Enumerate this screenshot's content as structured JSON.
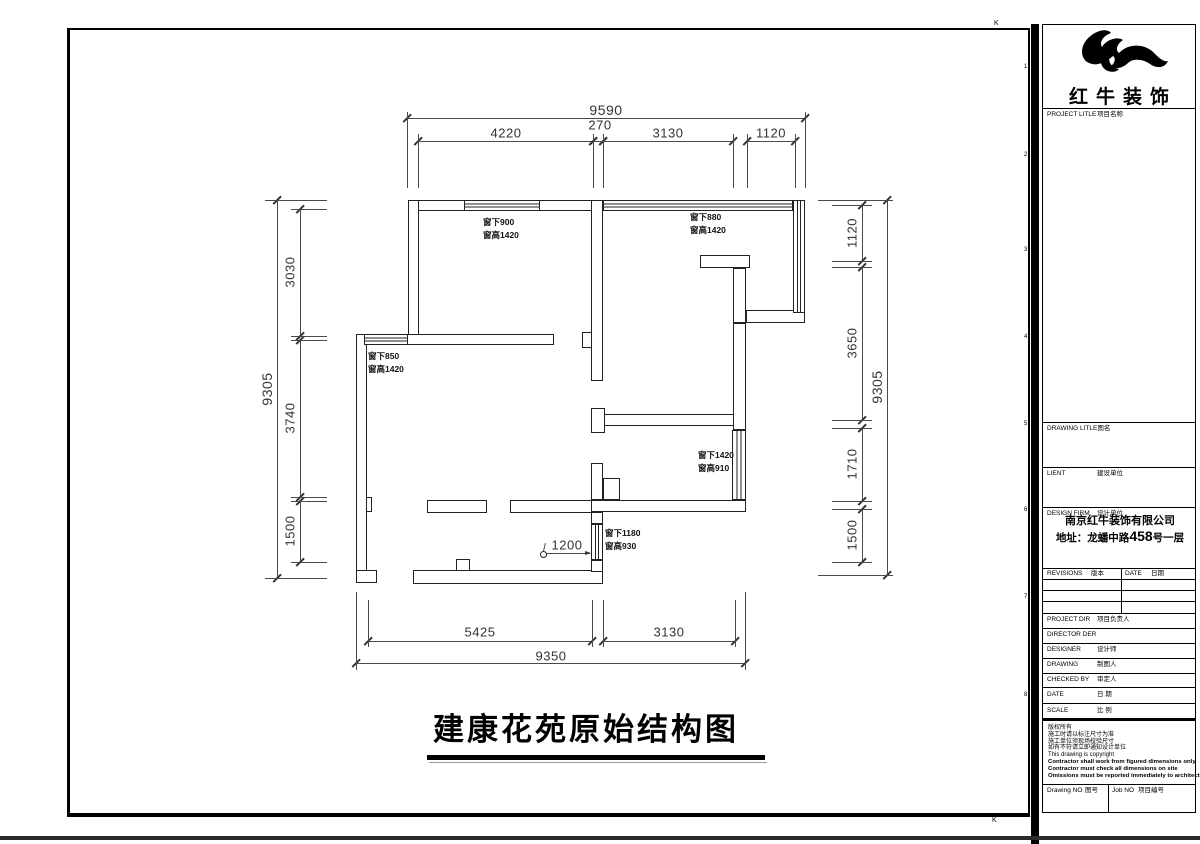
{
  "sheet": {
    "title": "建康花苑原始结构图",
    "grid_ref_top": "K",
    "grid_ref_bottom": "K",
    "side_numbers": [
      "1",
      "2",
      "3",
      "4",
      "5",
      "6",
      "7",
      "8"
    ]
  },
  "title_block": {
    "brand": "红牛装饰",
    "project_title_label": {
      "en": "PROJECT LITLE",
      "cn": "项目名称"
    },
    "drawing_title_label": {
      "en": "DRAWING LITLE",
      "cn": "图名"
    },
    "client_label": {
      "en": "LIENT",
      "cn": "建设单位"
    },
    "design_firm_label": {
      "en": "DESIGN FIRM",
      "cn": "设计单位"
    },
    "firm_name": "南京红牛装饰有限公司",
    "firm_address": {
      "prefix": "地址：龙蟠中路",
      "number": "458",
      "suffix": "号一层"
    },
    "revisions_label": {
      "en": "REVISIONS",
      "cn": "版本"
    },
    "rev_date_label": {
      "en": "DATE",
      "cn": "日期"
    },
    "project_dir_label": {
      "en": "PROJECT DIR",
      "cn": "项目负责人"
    },
    "director_label": {
      "en": "DIRECTOR DER",
      "cn": ""
    },
    "designer_label": {
      "en": "DESIGNER",
      "cn": "设计师"
    },
    "drawing_label": {
      "en": "DRAWING",
      "cn": "制图人"
    },
    "checked_label": {
      "en": "CHECKED BY",
      "cn": "审定人"
    },
    "date_label": {
      "en": "DATE",
      "cn": "日 期"
    },
    "scale_label": {
      "en": "SCALE",
      "cn": "比 例"
    },
    "drawing_no_label": {
      "en": "Drawing NO",
      "cn": "图号"
    },
    "job_no_label": {
      "en": "Job NO",
      "cn": "项目编号"
    },
    "copyright_lines": [
      {
        "text": "版权所有",
        "bold": false
      },
      {
        "text": "施工时请以标注尺寸为准",
        "bold": false
      },
      {
        "text": "施工单位须现场校验尺寸",
        "bold": false
      },
      {
        "text": "如有不符请立即通知设计单位",
        "bold": false
      },
      {
        "text": "This drawing is copyright",
        "bold": false
      },
      {
        "text": "Contractor shall work from figured dimensions only",
        "bold": true
      },
      {
        "text": "Contractor must check all dimensions on site",
        "bold": true
      },
      {
        "text": "Omissions must be reported immediately to architects",
        "bold": true
      }
    ]
  },
  "plan": {
    "walls": [
      [
        408,
        200,
        58,
        11
      ],
      [
        538,
        200,
        65,
        11
      ],
      [
        408,
        200,
        11,
        145
      ],
      [
        406,
        334,
        148,
        11
      ],
      [
        356,
        334,
        11,
        240
      ],
      [
        366,
        497,
        6,
        15
      ],
      [
        356,
        570,
        21,
        13
      ],
      [
        413,
        570,
        190,
        14
      ],
      [
        456,
        559,
        14,
        12
      ],
      [
        591,
        200,
        12,
        181
      ],
      [
        582,
        332,
        10,
        16
      ],
      [
        591,
        414,
        155,
        12
      ],
      [
        591,
        408,
        14,
        25
      ],
      [
        700,
        255,
        50,
        13
      ],
      [
        733,
        268,
        13,
        55
      ],
      [
        746,
        310,
        59,
        13
      ],
      [
        733,
        323,
        13,
        107
      ],
      [
        591,
        500,
        155,
        12
      ],
      [
        427,
        500,
        60,
        13
      ],
      [
        510,
        500,
        82,
        13
      ],
      [
        591,
        463,
        12,
        37
      ],
      [
        603,
        478,
        17,
        22
      ],
      [
        591,
        512,
        12,
        12
      ],
      [
        591,
        560,
        12,
        12
      ]
    ],
    "windows": [
      {
        "x": 464,
        "y": 200,
        "w": 76,
        "h": 11,
        "dir": "h"
      },
      {
        "x": 603,
        "y": 200,
        "w": 190,
        "h": 11,
        "dir": "h"
      },
      {
        "x": 793,
        "y": 200,
        "w": 12,
        "h": 113,
        "dir": "v"
      },
      {
        "x": 364,
        "y": 334,
        "w": 44,
        "h": 11,
        "dir": "h"
      },
      {
        "x": 732,
        "y": 430,
        "w": 14,
        "h": 70,
        "dir": "v"
      },
      {
        "x": 591,
        "y": 524,
        "w": 12,
        "h": 36,
        "dir": "v"
      }
    ],
    "window_notes": [
      {
        "x": 483,
        "y": 216,
        "lines": [
          "窗下900",
          "窗高1420"
        ]
      },
      {
        "x": 690,
        "y": 211,
        "lines": [
          "窗下880",
          "窗高1420"
        ]
      },
      {
        "x": 368,
        "y": 350,
        "lines": [
          "窗下850",
          "窗高1420"
        ]
      },
      {
        "x": 698,
        "y": 449,
        "lines": [
          "窗下1420",
          "窗高910"
        ]
      },
      {
        "x": 605,
        "y": 527,
        "lines": [
          "窗下1180",
          "窗高930"
        ]
      }
    ],
    "interior_dim": {
      "label": "1200",
      "x1": 546,
      "x2": 590,
      "y": 553,
      "lx": 567,
      "ly": 545
    }
  },
  "dimensions": {
    "top": [
      {
        "label": "9590",
        "x1": 407,
        "x2": 805,
        "y": 118,
        "lx": 606,
        "ly": 110,
        "fs": 14
      },
      {
        "label": "4220",
        "x1": 418,
        "x2": 593,
        "y": 141,
        "lx": 506,
        "ly": 133
      },
      {
        "label": "270",
        "x1": 593,
        "x2": 603,
        "y": 141,
        "lx": 600,
        "ly": 125
      },
      {
        "label": "3130",
        "x1": 603,
        "x2": 733,
        "y": 141,
        "lx": 668,
        "ly": 133
      },
      {
        "label": "1120",
        "x1": 747,
        "x2": 795,
        "y": 141,
        "lx": 771,
        "ly": 133
      }
    ],
    "bottom": [
      {
        "label": "5425",
        "x1": 368,
        "x2": 592,
        "y": 641,
        "lx": 480,
        "ly": 632
      },
      {
        "label": "3130",
        "x1": 603,
        "x2": 735,
        "y": 641,
        "lx": 669,
        "ly": 632
      },
      {
        "label": "9350",
        "x1": 356,
        "x2": 745,
        "y": 663,
        "lx": 551,
        "ly": 656
      }
    ],
    "left": [
      {
        "label": "9305",
        "y1": 200,
        "y2": 578,
        "x": 277,
        "lcy": 389,
        "fs": 14
      },
      {
        "label": "3030",
        "y1": 209,
        "y2": 336,
        "x": 300,
        "lcy": 272
      },
      {
        "label": "3740",
        "y1": 340,
        "y2": 497,
        "x": 300,
        "lcy": 418
      },
      {
        "label": "1500",
        "y1": 501,
        "y2": 562,
        "x": 300,
        "lcy": 531
      }
    ],
    "right": [
      {
        "label": "1120",
        "y1": 205,
        "y2": 261,
        "x": 862,
        "lcy": 233
      },
      {
        "label": "3650",
        "y1": 267,
        "y2": 420,
        "x": 862,
        "lcy": 343
      },
      {
        "label": "1710",
        "y1": 428,
        "y2": 501,
        "x": 862,
        "lcy": 464
      },
      {
        "label": "1500",
        "y1": 509,
        "y2": 562,
        "x": 862,
        "lcy": 535
      },
      {
        "label": "9305",
        "y1": 200,
        "y2": 575,
        "x": 887,
        "lcy": 387,
        "fs": 14
      }
    ],
    "ext_top_outer": [
      407,
      805
    ],
    "ext_top_inner": [
      418,
      593,
      603,
      733,
      747,
      795
    ],
    "ext_left_outer": [
      200,
      578
    ],
    "ext_left_inner": [
      209,
      336,
      340,
      497,
      501,
      562
    ],
    "ext_right_outer": [
      200,
      575
    ],
    "ext_right_inner": [
      205,
      261,
      267,
      420,
      428,
      501,
      509,
      562
    ],
    "ext_bottom_outer": [
      356,
      745
    ],
    "ext_bottom_inner": [
      368,
      592,
      603,
      735
    ]
  }
}
